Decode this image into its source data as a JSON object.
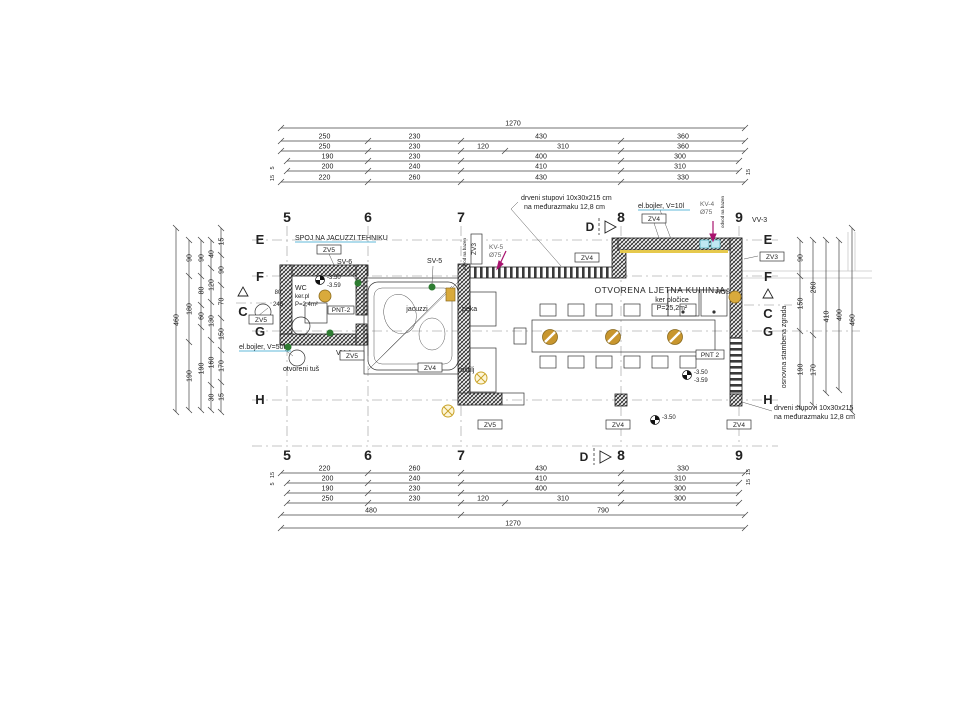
{
  "notes": {
    "top1": "drveni stupovi 10x30x215 cm",
    "top2": "na međurazmaku 12,8 cm",
    "bot1": "drveni stupovi 10x30x215",
    "bot2": "na međurazmaku 12,8 cm"
  },
  "grid": {
    "c5": "5",
    "c6": "6",
    "c7": "7",
    "c8": "8",
    "c9": "9",
    "rE": "E",
    "rF": "F",
    "rG": "G",
    "rH": "H",
    "secC": "C",
    "secD": "D"
  },
  "rooms": {
    "kitchen_title": "OTVORENA LJETNA KUHINJA",
    "kitchen_sub1": "ker pločice",
    "kitchen_sub2": "P=25,2m²",
    "wc1": "WC",
    "wc2": "ker.pl",
    "wc3": "P=2,4m²",
    "jacuzzi": "jacuzzi",
    "peka": "peka",
    "rostilj": "roštilj",
    "tus": "otvoreni tuš"
  },
  "labels": {
    "spoj": "SPOJ NA JACUZZI TEHNIKU",
    "bojler10": "el.bojler, V=10l",
    "bojler50": "el.bojler, V=50l",
    "sv5": "SV-5",
    "sv6": "SV-6",
    "vv3": "VV-3",
    "vv4": "VV-4",
    "kv4": "KV-4",
    "kv5": "KV-5",
    "fi75": "Ø75",
    "zv3": "ZV3",
    "zv4": "ZV4",
    "zv5": "ZV5",
    "pnt2": "PNT 2",
    "pnt2wc": "PNT-2",
    "ros": "ROŠ",
    "dovod": "odvod na bazen",
    "osnovna": "osnovna stambena zgrada"
  },
  "elevations": {
    "e350": "-3.50",
    "e359": "-3.59"
  },
  "dims": {
    "top": [
      [
        "1270"
      ],
      [
        "250",
        "230",
        "430",
        "360"
      ],
      [
        "250",
        "230",
        "120",
        "310",
        "360"
      ],
      [
        "190",
        "230",
        "400",
        "300"
      ],
      [
        "200",
        "240",
        "410",
        "310"
      ],
      [
        "220",
        "260",
        "430",
        "330"
      ]
    ],
    "bottom": [
      [
        "220",
        "260",
        "430",
        "330"
      ],
      [
        "200",
        "240",
        "410",
        "310"
      ],
      [
        "190",
        "230",
        "400",
        "300"
      ],
      [
        "250",
        "230",
        "120",
        "310",
        "300"
      ],
      [
        "480",
        "790"
      ],
      [
        "1270"
      ]
    ],
    "left": [
      [
        "460"
      ],
      [
        "90",
        "180",
        "190"
      ],
      [
        "90",
        "80",
        "60",
        "190"
      ],
      [
        "40",
        "120",
        "130",
        "160",
        "30"
      ],
      [
        "15",
        "90",
        "70",
        "150",
        "170",
        "15"
      ]
    ],
    "right": [
      [
        "90",
        "150",
        "190"
      ],
      [
        "260",
        "170"
      ],
      [
        "410"
      ],
      [
        "400"
      ],
      [
        "460"
      ]
    ],
    "wc_w": "80",
    "wc_l": "246",
    "smalls": [
      "15",
      "5",
      "15",
      "15",
      "5",
      "15",
      "15"
    ]
  },
  "colors": {
    "magenta": "#a8136e",
    "cyan": "#2ba3cc",
    "green": "#3f8f3f",
    "gold": "#c8962e",
    "orange": "#e09a3c",
    "gray": "#9a9a9a"
  }
}
